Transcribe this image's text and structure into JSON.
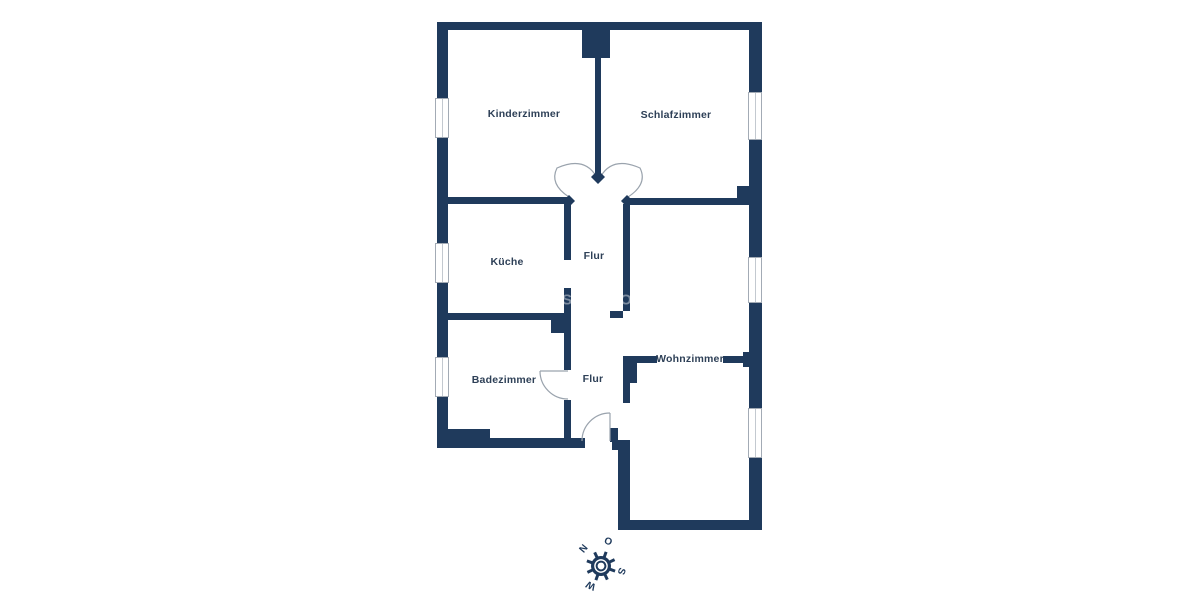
{
  "image_type": "apartment-floor-plan",
  "rooms": [
    {
      "id": "kinderzimmer",
      "label": "Kinderzimmer"
    },
    {
      "id": "schlafzimmer",
      "label": "Schlafzimmer"
    },
    {
      "id": "kueche",
      "label": "Küche"
    },
    {
      "id": "flur-upper",
      "label": "Flur"
    },
    {
      "id": "badezimmer",
      "label": "Badezimmer"
    },
    {
      "id": "flur-lower",
      "label": "Flur"
    },
    {
      "id": "wohnzimmer",
      "label": "Wohnzimmer"
    }
  ],
  "compass": {
    "north": "N",
    "east": "O",
    "south": "S",
    "west": "W"
  },
  "watermark": {
    "letter_left": "S",
    "letter_right": "O"
  },
  "colors": {
    "wall": "#1f3a5c",
    "label_text": "#2e4057",
    "door_swing": "#9aa3ad",
    "window_frame": "#a3abb5",
    "background": "#ffffff"
  }
}
